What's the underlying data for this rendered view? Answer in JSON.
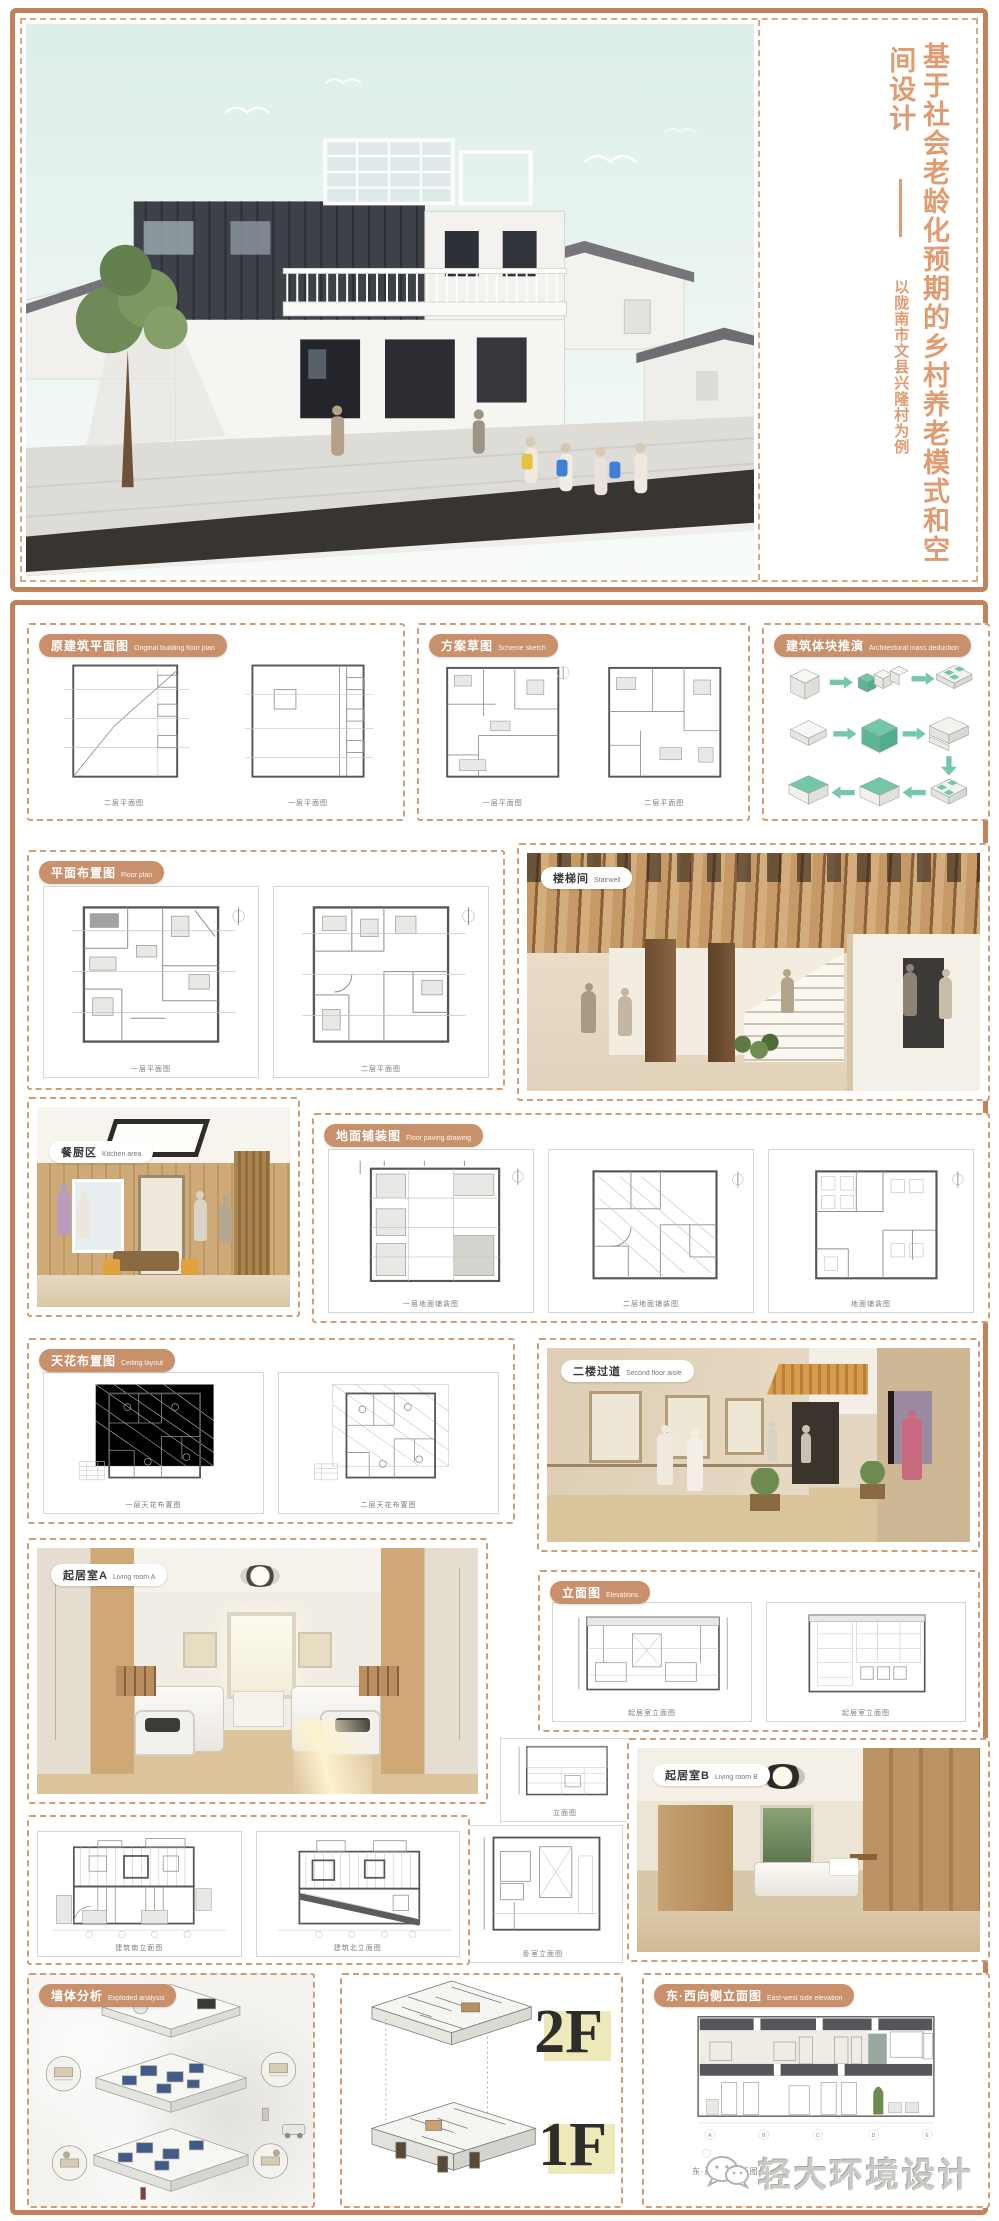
{
  "poster": {
    "title": {
      "line_main": "基于社会老龄化预期的乡村养老模式和空",
      "line_wrap": "间设计",
      "subtitle": "以陇南市文县兴隆村为例"
    },
    "logo_text": "轻大环境设计",
    "floor_labels": {
      "f2": "2F",
      "f1": "1F"
    },
    "panels": {
      "original_plan": {
        "zh": "原建筑平面图",
        "en": "Original building floor plan",
        "captions": [
          "二层平面图",
          "一层平面图"
        ]
      },
      "scheme_sketch": {
        "zh": "方案草图",
        "en": "Scheme sketch",
        "captions": [
          "一层平面图",
          "二层平面图"
        ]
      },
      "massing": {
        "zh": "建筑体块推演",
        "en": "Architectural mass deduction"
      },
      "floor_plan": {
        "zh": "平面布置图",
        "en": "Floor plan",
        "captions": [
          "一层平面图",
          "二层平面图"
        ]
      },
      "stairwell": {
        "zh": "楼梯间",
        "en": "Stairwell"
      },
      "kitchen": {
        "zh": "餐厨区",
        "en": "Kitchen area"
      },
      "paving": {
        "zh": "地面铺装图",
        "en": "Floor paving drawing",
        "captions": [
          "一层地面铺装图",
          "二层地面铺装图",
          "地面铺装图"
        ]
      },
      "ceiling": {
        "zh": "天花布置图",
        "en": "Ceiling layout",
        "captions": [
          "一层天花布置图",
          "二层天花布置图"
        ]
      },
      "aisle": {
        "zh": "二楼过道",
        "en": "Second floor aisle"
      },
      "living_a": {
        "zh": "起居室A",
        "en": "Living room A"
      },
      "interior_elev": {
        "zh": "立面图",
        "en": "Elevations",
        "captions": [
          "起居室立面图",
          "起居室立面图"
        ]
      },
      "detail_small": {
        "caption": "立面图"
      },
      "detail_large": {
        "caption": "卧室立面图"
      },
      "living_b": {
        "zh": "起居室B",
        "en": "Living room B"
      },
      "building_elev": {
        "captions": [
          "建筑南立面图",
          "建筑北立面图"
        ]
      },
      "exploded": {
        "zh": "墙体分析",
        "en": "Exploded analysis"
      },
      "section": {
        "zh": "东·西向侧立面图",
        "en": "East-west side elevation",
        "caption": "东·西向侧立面图"
      }
    }
  }
}
